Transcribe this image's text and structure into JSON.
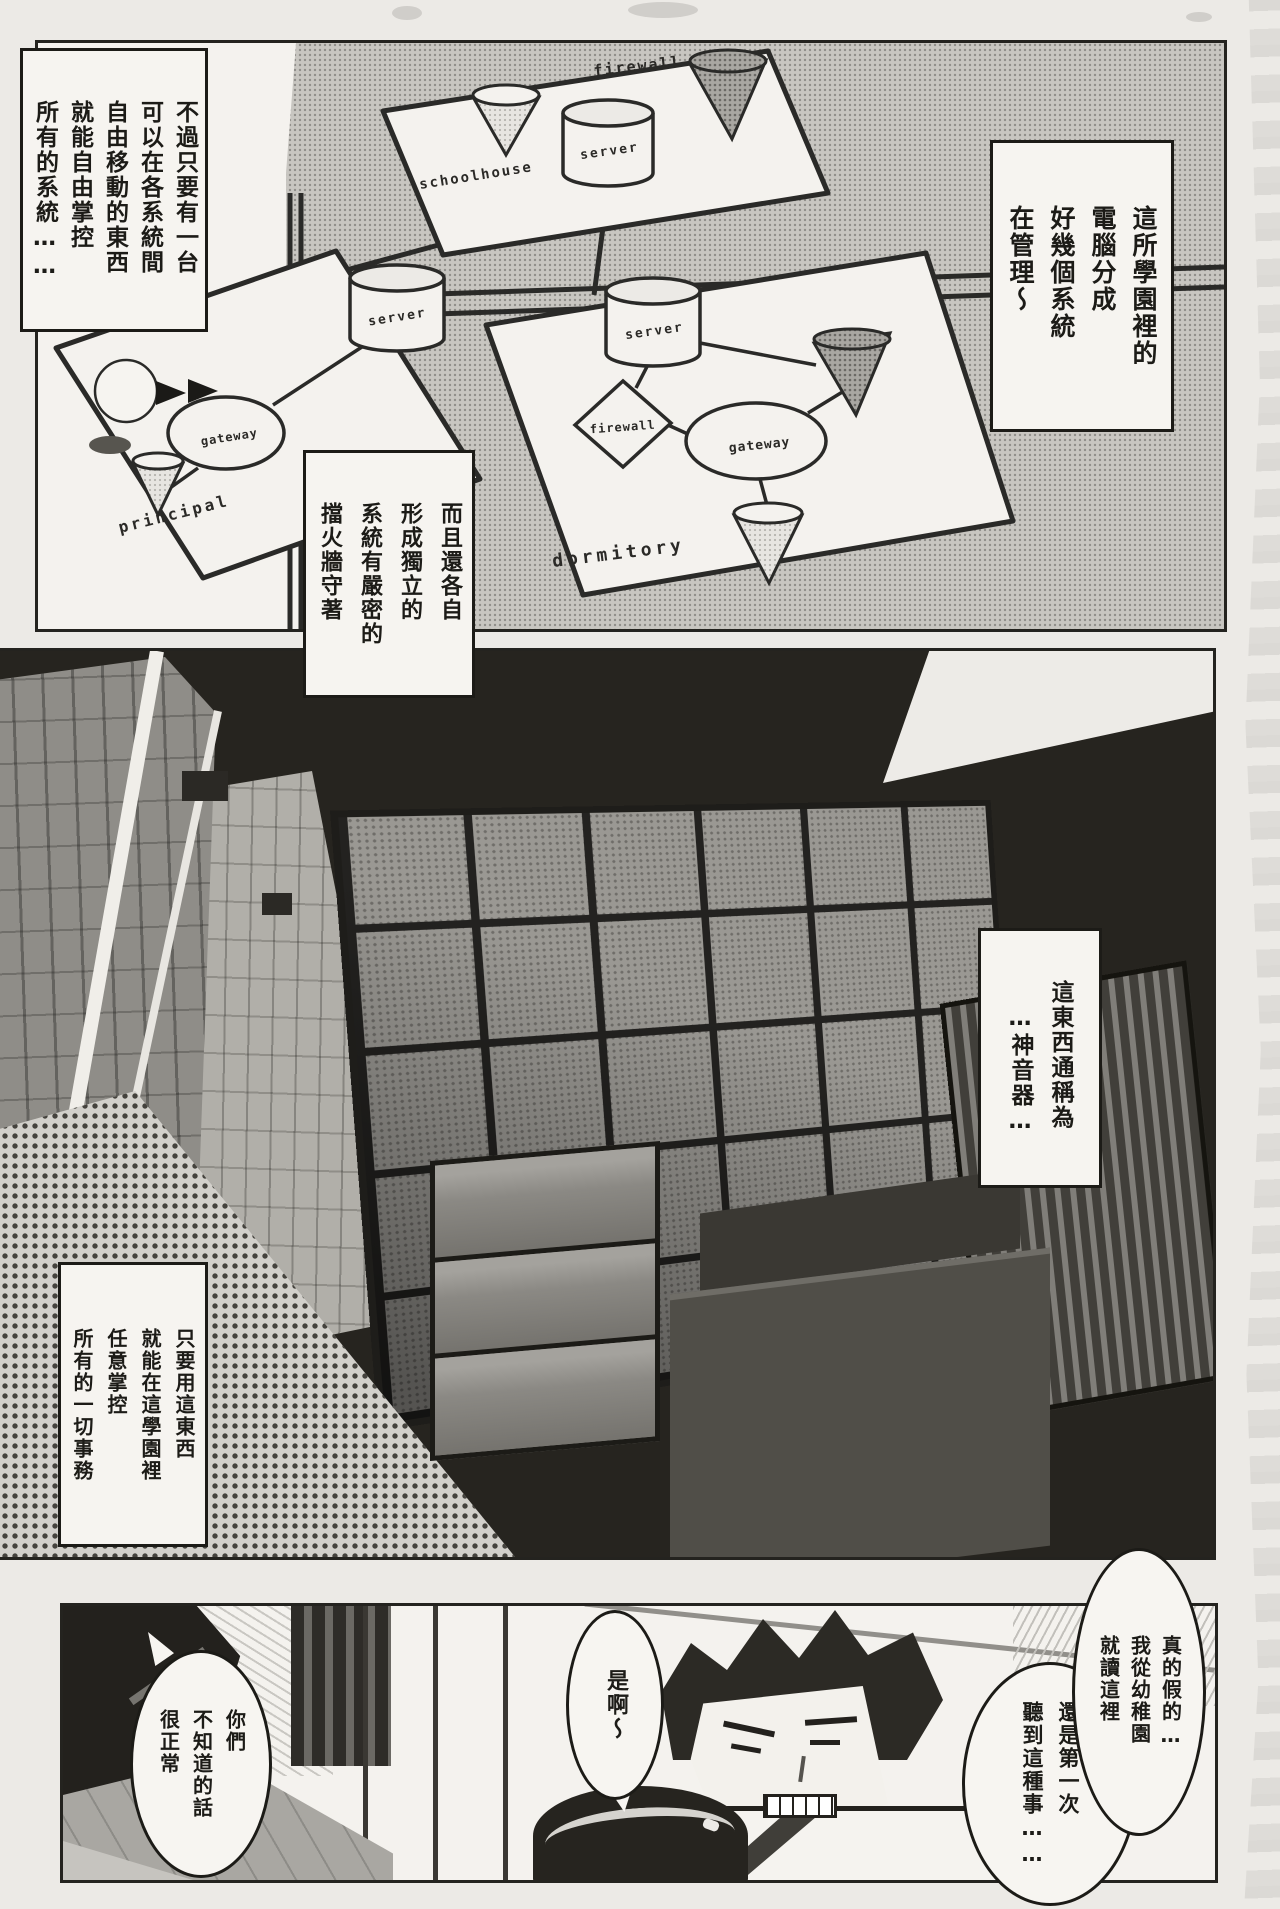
{
  "page": {
    "kind": "scanned manga page",
    "language": "zh-Hant"
  },
  "panel1": {
    "caption_top_left": "不過只要有一台\n可以在各系統間\n自由移動的東西\n就能自由掌控\n所有的系統……",
    "caption_right": "這所學園裡的\n電腦分成\n好幾個系統\n在管理～",
    "caption_firewall": "而且還各自\n形成獨立的\n系統有嚴密的\n擋火牆守著",
    "diagram": {
      "schoolhouse": "schoolhouse",
      "principal": "principal",
      "dormitory": "dormitory",
      "firewall_top": "firewall",
      "server_top": "server",
      "server_principal": "server",
      "gateway_principal": "gateway",
      "server_dorm": "server",
      "firewall_dorm": "firewall",
      "gateway_dorm": "gateway"
    }
  },
  "panel2": {
    "caption_device": "這東西通稱為\n　…神音器…",
    "caption_control": "只要用這東西\n就能在這學園裡\n任意掌控\n所有的一切事務"
  },
  "panel3": {
    "balloon_surprised": "真的假的…\n我從幼稚園\n就讀這裡",
    "balloon_first_time": "還是第一次\n聽到這種事……",
    "balloon_yeah": "是啊～",
    "balloon_normal": "你們\n不知道的話\n很正常"
  }
}
